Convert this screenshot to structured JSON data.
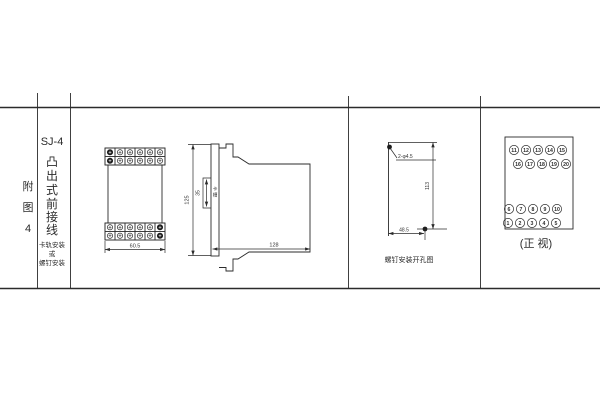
{
  "colors": {
    "ink": "#2b2b2b",
    "bg": "#ffffff"
  },
  "title_block": {
    "figure_chars": [
      "附",
      "图",
      "4"
    ],
    "model": "SJ-4",
    "style_chars": [
      "凸",
      "出",
      "式",
      "前",
      "接",
      "线"
    ],
    "mount_lines": [
      "卡轨安装",
      "或",
      "螺钉安装"
    ]
  },
  "front_view": {
    "width_dim": "60.5"
  },
  "side_view": {
    "height_dim": "125",
    "slot_dim": "35",
    "slot_label_chars": [
      "卡",
      "槽"
    ],
    "depth_dim": "128"
  },
  "drill_view": {
    "holes_label": "2-φ4.5",
    "height_dim": "113",
    "width_dim": "48.5",
    "caption": "螺钉安装开孔图"
  },
  "terminal_view": {
    "caption": "(正 视)",
    "rows": [
      [
        "11",
        "12",
        "13",
        "14",
        "15"
      ],
      [
        "16",
        "17",
        "18",
        "19",
        "20"
      ],
      [
        "6",
        "7",
        "8",
        "9",
        "10"
      ],
      [
        "1",
        "2",
        "3",
        "4",
        "5"
      ]
    ]
  }
}
